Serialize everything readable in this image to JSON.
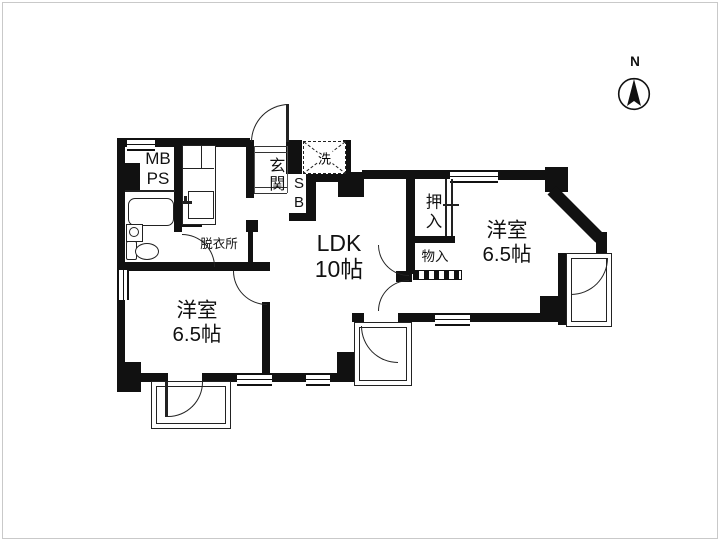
{
  "page": {
    "background": "#ffffff",
    "wall_color": "#111111",
    "line_color": "#222222"
  },
  "compass": {
    "label": "N"
  },
  "rooms": {
    "ldk": {
      "name": "LDK",
      "size": "10帖"
    },
    "bedroom_right": {
      "name": "洋室",
      "size": "6.5帖"
    },
    "bedroom_left": {
      "name": "洋室",
      "size": "6.5帖"
    }
  },
  "labels": {
    "meter_pipe_space": [
      "MB",
      "PS"
    ],
    "entrance": "玄関",
    "washer": "洗",
    "shoe_box": [
      "S",
      "B"
    ],
    "closet": "押入",
    "storage": "物入",
    "dressing_room": "脱衣所"
  }
}
